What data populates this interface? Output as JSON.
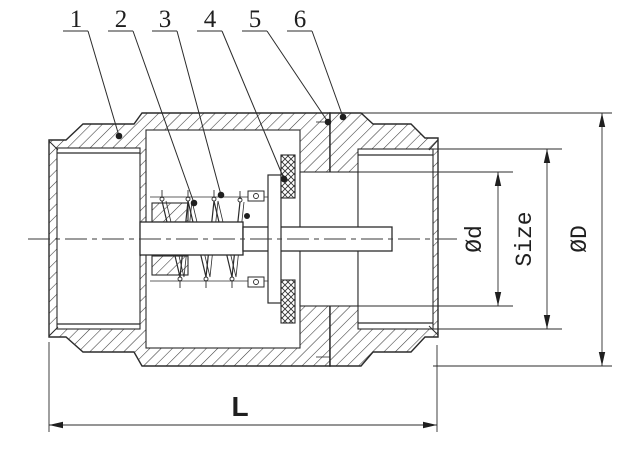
{
  "drawing": {
    "title": "check-valve-cross-section",
    "background": "#ffffff",
    "line_color": "#2b2b2b",
    "callouts": [
      "1",
      "2",
      "3",
      "4",
      "5",
      "6"
    ],
    "dimensions": {
      "inner_diameter": "Ød",
      "port_size": "Size",
      "outer_diameter": "ØD",
      "length": "L"
    }
  }
}
